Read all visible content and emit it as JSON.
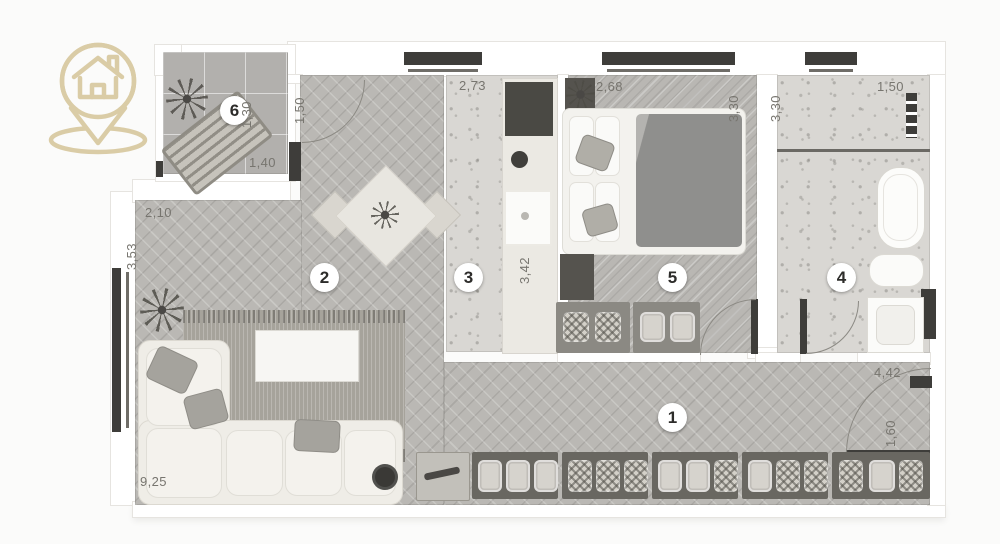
{
  "logo": {
    "icon": "house-location-pin",
    "color": "#d7c79d"
  },
  "rooms": {
    "hall": "1",
    "living": "2",
    "kitchen": "3",
    "bath": "4",
    "bedroom": "5",
    "balcony": "6"
  },
  "dimensions": {
    "living_top": "2,10",
    "living_left": "3,53",
    "living_bottom": "9,25",
    "balcony_door": "1,50",
    "kitchen_top": "2,73",
    "kitchen_right": "3,42",
    "bedroom_top": "2,68",
    "bedroom_right": "3,30",
    "bath_left": "3,30",
    "bath_top": "1,50",
    "balcony_right": "1,30",
    "balcony_bottom": "1,40",
    "hall_entry": "4,42",
    "entry_door": "1,60"
  },
  "colors": {
    "accent_gold": "#d7c79d",
    "wall_dark": "#3e3d3a"
  }
}
